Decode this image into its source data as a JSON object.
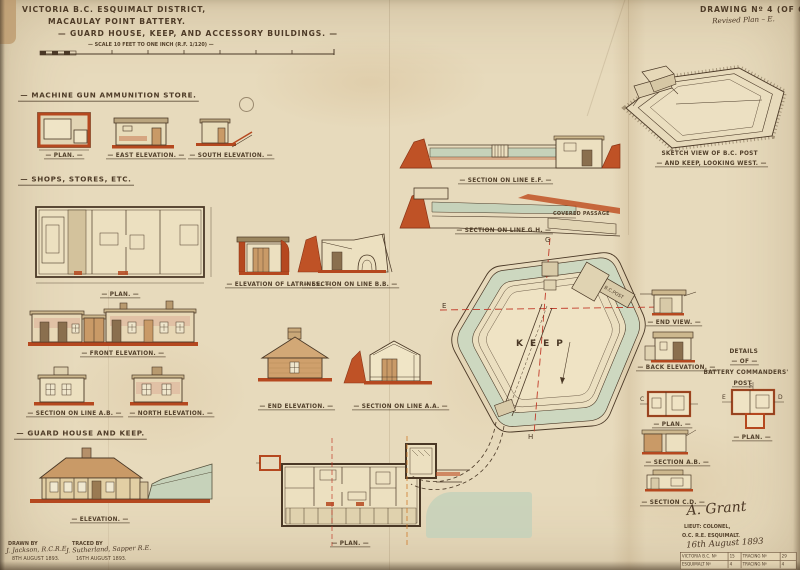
{
  "colors": {
    "paper": "#e7dabc",
    "ink": "#4a3826",
    "red": "#b5481f",
    "green": "#c6d2ba",
    "tan": "#c99a67",
    "wash_pink": "#d8a18b"
  },
  "meta": {
    "title1": "VICTORIA B.C. ESQUIMALT DISTRICT,",
    "title2": "MACAULAY POINT BATTERY.",
    "title3": "GUARD HOUSE, KEEP, AND ACCESSORY BUILDINGS.",
    "scale_note": "SCALE 10 FEET TO ONE INCH (R.F. 1/120)",
    "drawing_no": "DRAWING Nº 4 (OF 6).",
    "drawing_note": "Revised Plan – E."
  },
  "mg_store": {
    "header": "MACHINE GUN AMMUNITION STORE.",
    "plan": "PLAN.",
    "east": "EAST ELEVATION.",
    "south": "SOUTH ELEVATION."
  },
  "shops": {
    "header": "SHOPS, STORES, ETC.",
    "plan": "PLAN.",
    "front": "FRONT ELEVATION.",
    "section_ab": "SECTION ON LINE A.B.",
    "north": "NORTH ELEVATION."
  },
  "latrines": {
    "elevation": "ELEVATION OF LATRINES.",
    "section_bb": "SECTION ON LINE B.B."
  },
  "cottage": {
    "end": "END ELEVATION.",
    "section_aa": "SECTION ON LINE A.A."
  },
  "guard": {
    "header": "GUARD HOUSE AND KEEP.",
    "elevation": "ELEVATION.",
    "plan": "PLAN."
  },
  "keep": {
    "section_ef": "SECTION ON LINE E.F.",
    "section_gh": "SECTION ON LINE G.H.",
    "covered_passage": "COVERED PASSAGE",
    "keep_label": "KEEP",
    "bc_post": "B.C.POST",
    "g": "G",
    "e": "E",
    "f": "F",
    "h": "H"
  },
  "sketch": {
    "line1": "SKETCH VIEW OF B.C. POST",
    "line2": "AND KEEP, LOOKING WEST."
  },
  "bc_details": {
    "end_view": "END VIEW.",
    "back_elevation": "BACK ELEVATION.",
    "details_1": "DETAILS",
    "details_2": "OF",
    "details_3": "BATTERY COMMANDERS'",
    "details_4": "POST",
    "plan_a": "PLAN.",
    "plan_b": "PLAN.",
    "section_ab": "SECTION A.B.",
    "section_cd": "SECTION C.D.",
    "f": "F",
    "e": "E",
    "c": "C",
    "d": "D"
  },
  "footer": {
    "drawn_label": "DRAWN BY",
    "drawn_name": "J. Jackson, R.C.R.E.",
    "drawn_date": "8TH AUGUST 1893.",
    "traced_label": "TRACED BY",
    "traced_name": "J. Sutherland, Sapper R.E.",
    "traced_date": "16TH AUGUST 1893.",
    "signature": "A. Grant",
    "rank": "LIEUT: COLONEL,",
    "office": "O.C. R.E. ESQUIMALT.",
    "sig_date": "16th August 1893",
    "stamp": {
      "r1c1": "VICTORIA B.C. Nº",
      "r1c2": "15",
      "r1c3": "TRACING Nº",
      "r1c4": "29",
      "r2c1": "ESQUIMALT Nº",
      "r2c2": "4",
      "r2c3": "TRACING Nº",
      "r2c4": "4"
    }
  }
}
